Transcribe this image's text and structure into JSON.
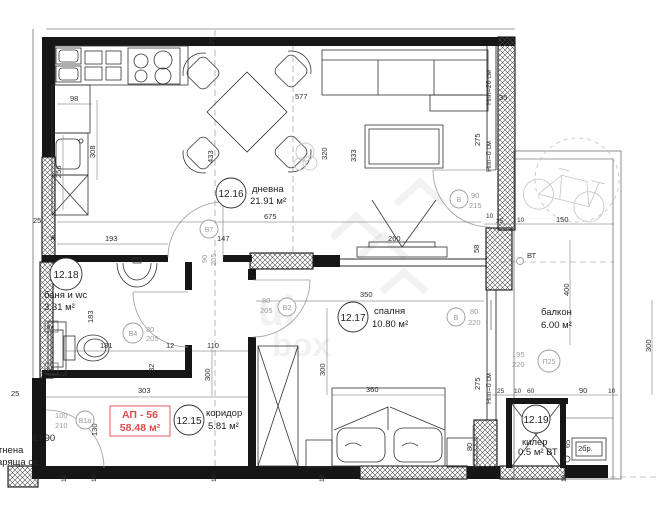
{
  "apartment": {
    "code": "АП - 56",
    "area": "58.48 м²"
  },
  "rooms": {
    "living": {
      "number": "12.16",
      "name": "дневна",
      "area": "21.91 м²"
    },
    "bedroom": {
      "number": "12.17",
      "name": "спалня",
      "area": "10.80 м²"
    },
    "bath": {
      "number": "12.18",
      "name": "баня и wc",
      "area": "3.31 м²"
    },
    "corridor": {
      "number": "12.15",
      "name": "коридор",
      "area": "5.81 м²"
    },
    "storage": {
      "number": "12.19",
      "name": "килер",
      "area": "0.5 м² ВТ"
    },
    "balcony": {
      "name": "балкон",
      "area": "6.00 м²"
    }
  },
  "openings": {
    "b7": {
      "code": "В7",
      "w": "90",
      "h": "205"
    },
    "b4": {
      "code": "В4",
      "w": "80",
      "h": "205"
    },
    "b2": {
      "code": "В2",
      "w": "80",
      "h": "205"
    },
    "b1": {
      "code": "В1а",
      "w": "100",
      "h": "210",
      "offset": "130"
    },
    "balcony_door": {
      "code": "В",
      "w": "90",
      "h": "215"
    },
    "bedroom_window": {
      "code": "В",
      "w": "80",
      "h": "220"
    },
    "p25": {
      "code": "П25",
      "w": "195",
      "h": "220"
    }
  },
  "fire_door": {
    "line1": "EI 90",
    "line2": "ътнена",
    "line3": "варяща се"
  },
  "levels": {
    "npp26": "Нпп=26 см",
    "npp0": "Нпп=0 см"
  },
  "annotations": {
    "vt": "ВТ",
    "count2": "2бр.",
    "vk": "вк",
    "ov": "ов",
    "star": "*"
  },
  "dims": {
    "t25": "25",
    "w25": "25",
    "k98": "98",
    "k308": "308",
    "k256": "256",
    "k433": "433",
    "s577": "577",
    "l320": "320",
    "l333": "333",
    "l675": "675",
    "l147": "147",
    "l193": "193",
    "l275": "275",
    "tv260": "260",
    "tv58": "58",
    "b183": "183",
    "b181": "181",
    "b12": "12",
    "b110": "110",
    "b32": "32",
    "b303": "303",
    "c300": "300",
    "c130": "130",
    "bd350": "350",
    "bd300": "300",
    "bd360": "360",
    "bd275": "275",
    "bd80": "80",
    "bc35": "35",
    "bc10": "10",
    "bc25": "25",
    "bc150": "150",
    "bc400": "400",
    "bc300": "300",
    "bc60": "60",
    "bc90": "90",
    "k65": "65",
    "s10": "10"
  },
  "watermark": {
    "line1": "ui",
    "line2": "box"
  }
}
